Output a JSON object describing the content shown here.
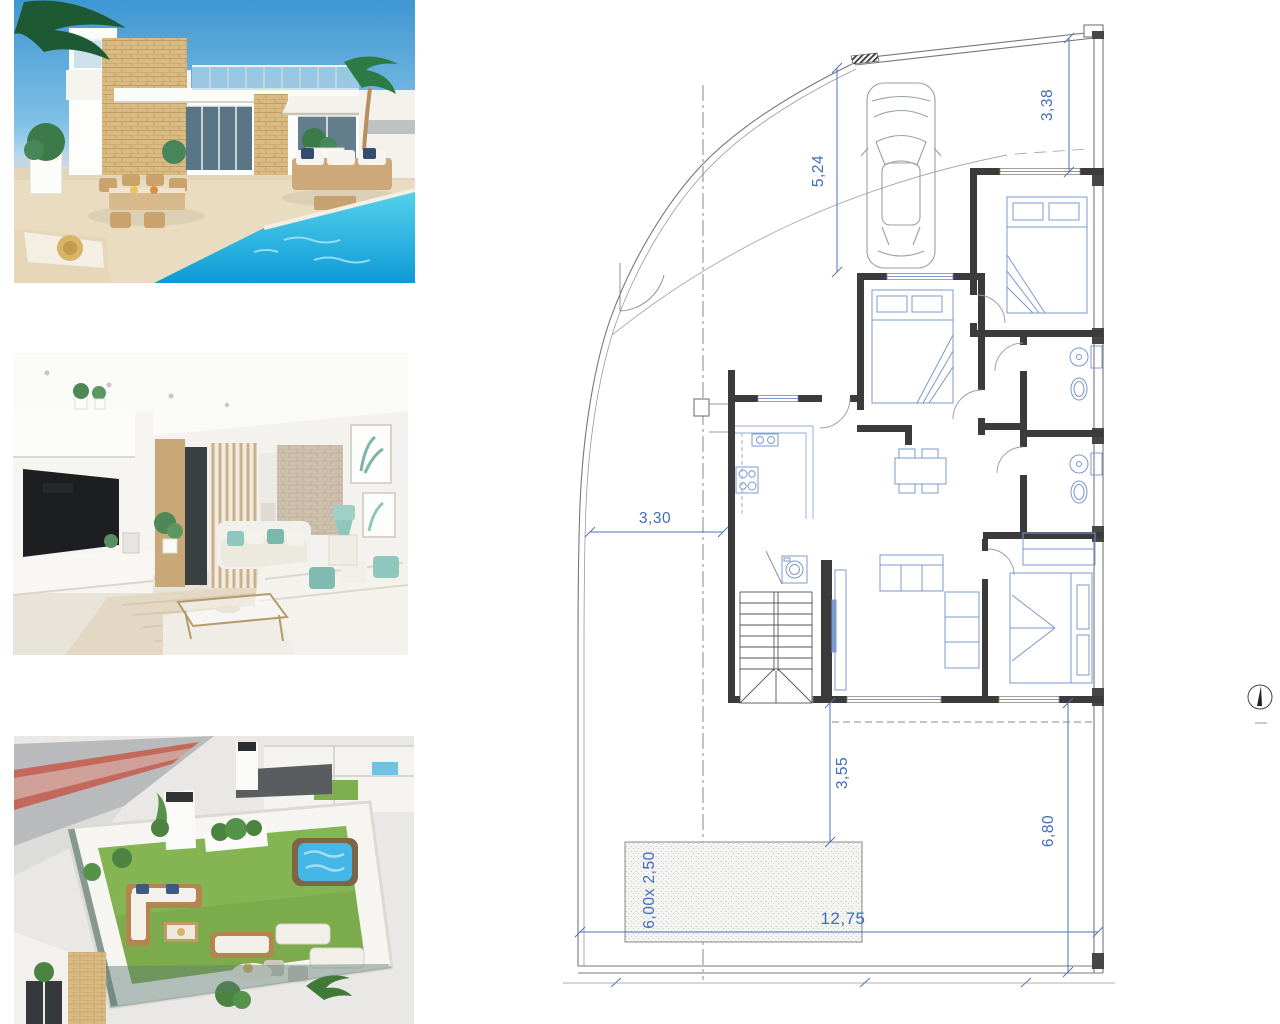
{
  "gallery": {
    "photos": [
      {
        "id": "villa-exterior-pool-photo"
      },
      {
        "id": "living-room-interior-photo"
      },
      {
        "id": "rooftop-terrace-aerial-photo"
      }
    ]
  },
  "floorplan": {
    "dims": {
      "driveway_length": "5,24",
      "front_setback": "3,38",
      "left_setback": "3,30",
      "terrace_depth": "3,55",
      "garden_depth": "6,80",
      "plot_width": "12,75",
      "pool_size": "6,00x 2,50"
    },
    "colors": {
      "dimension_blue": "#3f6db8",
      "furniture_blue": "#7b98cf",
      "wall_dark": "#3b3b3b",
      "pool_water": "#45b7e6",
      "grass_green": "#7cab4c",
      "sky_blue": "#3e96d2"
    }
  }
}
